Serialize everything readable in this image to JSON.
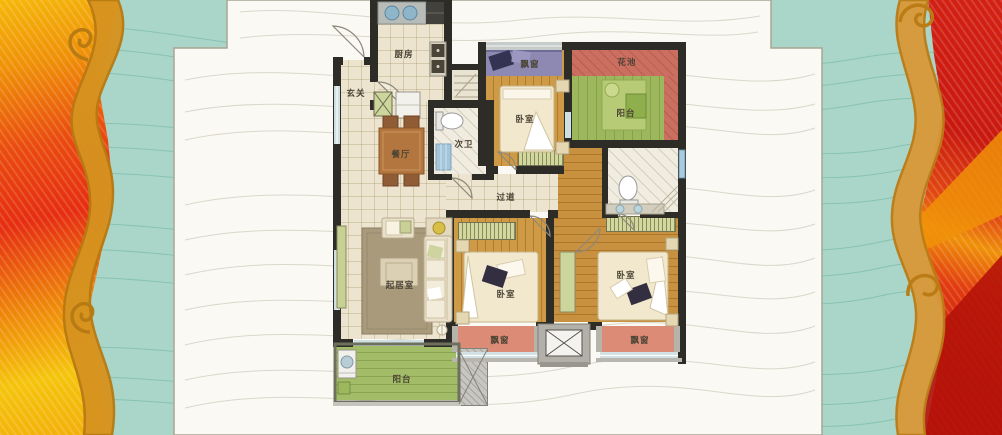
{
  "page": {
    "type": "apartment-floorplan-poster",
    "background_teal": "#a9d6c8",
    "panel_white": "#faf9f4"
  },
  "decor": {
    "left_border": "flame-wave-ornament",
    "right_border": "flame-wave-ornament",
    "flame_yellow": "#f5c40c",
    "flame_orange": "#ef9007",
    "flame_red": "#e62d10",
    "wave_band_orange": "#d6931f",
    "contour_line_teal": "#82bfae",
    "contour_line_panel": "#dbd7ca"
  },
  "floorplan": {
    "wall_color": "#2e2c27",
    "floor_wood": "#cf9a45",
    "floor_tile": "#ece4cf",
    "balcony_green": "#a3bc68",
    "flower_bed_red": "#cb6f60",
    "bay_window_purple": "#8d89b3",
    "bay_window_pink": "#dc8b76",
    "labels": [
      {
        "id": "kitchen",
        "text": "厨房"
      },
      {
        "id": "entry",
        "text": "玄关"
      },
      {
        "id": "dining",
        "text": "餐厅"
      },
      {
        "id": "second-bath",
        "text": "次卫"
      },
      {
        "id": "bay-window-top",
        "text": "飘窗"
      },
      {
        "id": "bedroom-top",
        "text": "卧室"
      },
      {
        "id": "flower-bed",
        "text": "花池"
      },
      {
        "id": "balcony-top",
        "text": "阳台"
      },
      {
        "id": "hallway",
        "text": "过道"
      },
      {
        "id": "living-room",
        "text": "起居室"
      },
      {
        "id": "bedroom-middle",
        "text": "卧室"
      },
      {
        "id": "bedroom-right",
        "text": "卧室"
      },
      {
        "id": "bay-window-left",
        "text": "飘窗"
      },
      {
        "id": "bay-window-right",
        "text": "飘窗"
      },
      {
        "id": "balcony-bottom",
        "text": "阳台"
      }
    ],
    "furniture_icons": [
      "double-sink",
      "stove",
      "fridge",
      "dining-table",
      "toilet",
      "shower",
      "bed",
      "wardrobe",
      "sofa",
      "armchair",
      "coffee-table",
      "tv-stand",
      "rug",
      "washer",
      "elevator",
      "balcony-table"
    ]
  }
}
